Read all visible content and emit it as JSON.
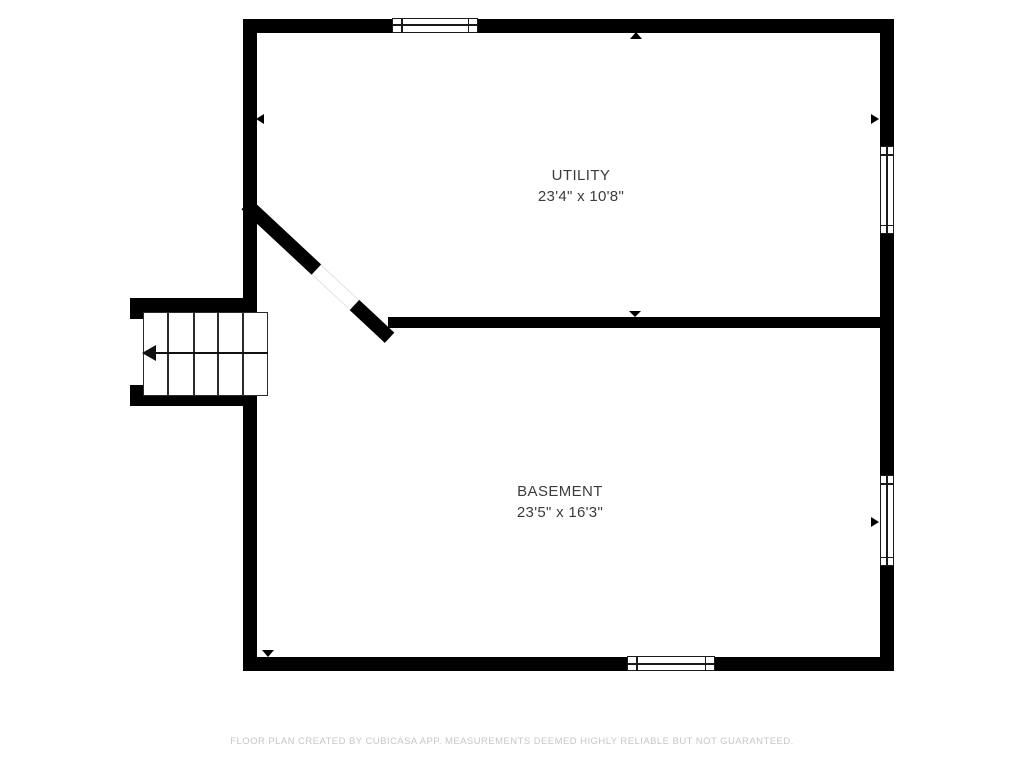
{
  "page": {
    "background_color": "#ffffff",
    "wall_color": "#000000",
    "label_color": "#3c3c3c",
    "footer_color": "#c6c6c6"
  },
  "rooms": {
    "utility": {
      "name": "UTILITY",
      "dimensions": "23'4\" x 10'8\""
    },
    "basement": {
      "name": "BASEMENT",
      "dimensions": "23'5\" x 16'3\""
    }
  },
  "stairs": {
    "steps": 5,
    "arrow_direction": "left"
  },
  "windows": [
    {
      "id": "top-wall-window",
      "orientation": "horizontal"
    },
    {
      "id": "right-wall-window-upper",
      "orientation": "vertical"
    },
    {
      "id": "right-wall-window-lower",
      "orientation": "vertical"
    },
    {
      "id": "bottom-wall-window",
      "orientation": "horizontal"
    }
  ],
  "wall_markers": [
    {
      "id": "top-wall-marker",
      "points": "up"
    },
    {
      "id": "left-wall-marker",
      "points": "left"
    },
    {
      "id": "right-wall-marker-upper",
      "points": "right"
    },
    {
      "id": "right-wall-marker-lower",
      "points": "right"
    },
    {
      "id": "divider-wall-marker",
      "points": "down"
    },
    {
      "id": "bottom-wall-marker",
      "points": "down"
    },
    {
      "id": "diagonal-wall-marker",
      "points": "down-left"
    }
  ],
  "door_opening": {
    "location": "diagonal-wall"
  },
  "footer": {
    "text": "FLOOR PLAN CREATED BY CUBICASA APP. MEASUREMENTS DEEMED HIGHLY RELIABLE BUT NOT GUARANTEED."
  }
}
